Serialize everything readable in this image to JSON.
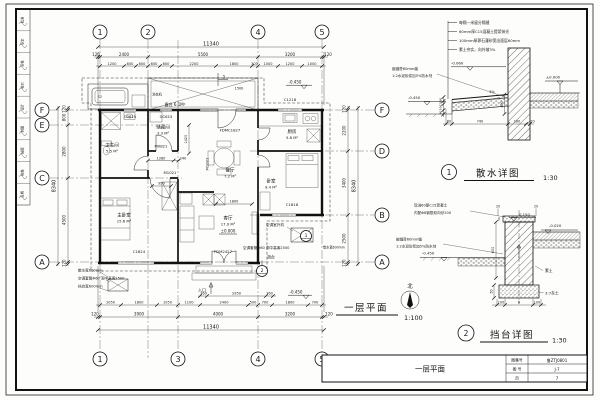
{
  "sheet": {
    "signature_cells": [
      "批准",
      "审定",
      "审核",
      "校对",
      "设计",
      "制图",
      "描图",
      "校核",
      "日期"
    ],
    "plan_title": "一层平面",
    "plan_scale": "1:100",
    "north_label": "北",
    "title_block": {
      "drawing_name": "一层平面",
      "atlas_label": "图集号",
      "atlas_no": "鲁ZTJ0801",
      "sheet_label": "图 号",
      "sheet_no": "J-7",
      "page_label": "页",
      "page_no": "7"
    }
  },
  "plan": {
    "grid": {
      "top": [
        "1",
        "2",
        "4",
        "5"
      ],
      "bottom": [
        "1",
        "3",
        "4",
        "5"
      ],
      "left": [
        "F",
        "E",
        "C",
        "A"
      ],
      "right": [
        "F",
        "D",
        "B",
        "A"
      ]
    },
    "dims": {
      "top_total": "11340",
      "top_major": [
        "120",
        "2400",
        "5500",
        "3200",
        "120"
      ],
      "top_minor": [
        "1200",
        "600",
        "600",
        "600",
        "600",
        "2200",
        "1800",
        "300",
        "1000",
        "1200",
        "1000"
      ],
      "bottom_total": "11340",
      "bottom_major": [
        "120",
        "3900",
        "4000",
        "3200",
        "120"
      ],
      "bottom_minor": [
        "1050",
        "1800",
        "1050",
        "1100",
        "2400",
        "500",
        "700",
        "1800",
        "700"
      ],
      "left_total": "8340",
      "left_segs": [
        "120",
        "800",
        "2800",
        "4500",
        "120"
      ],
      "right_total": "8340",
      "right_segs": [
        "120",
        "2200",
        "3400",
        "2500",
        "120"
      ],
      "entry": [
        "360",
        "2950",
        "360"
      ],
      "inner": [
        "1280",
        "240",
        "950",
        "1800",
        "1500",
        "1420"
      ]
    },
    "rooms": [
      {
        "name": "卫生间",
        "area": "5.5 M²"
      },
      {
        "name": "储藏间",
        "area": "3.3 M²"
      },
      {
        "name": "厨房",
        "area": "5.8 M²"
      },
      {
        "name": "餐厅",
        "area": "7.2 M²"
      },
      {
        "name": "主卧室",
        "area": "15.6 M²"
      },
      {
        "name": "客厅",
        "area": "17.0 M²"
      },
      {
        "name": "卧室",
        "area": "9.4 M²"
      }
    ],
    "terrace_label": "露台 6.1M²",
    "washer_label": "洗衣机",
    "openings": {
      "c0615": "C0615",
      "gc615": "GC615",
      "c1218": "C1218",
      "fdmc1827": "FDMC1827",
      "c1824": "C1824",
      "fdm2427": "FDM2427",
      "c1818": "C1818",
      "m0821": "M0821",
      "m1021a": "M1021",
      "m1021b": "M1021"
    },
    "levels": {
      "zero": "±0.000",
      "top": "-0.450",
      "bottom": "-0.450"
    },
    "notes": {
      "left1": "散水宽600mm",
      "left2": "空调套管Φ60 洞中高离2500",
      "left3": "挡台宽600mm",
      "right1": "空调室外机",
      "right2": "空调套管Φ60 洞中高离2500",
      "right3": "散水宽600mm",
      "dangtai": "挡台",
      "entry": "入口"
    },
    "markers": {
      "section": "1",
      "d1": "1",
      "d2": "2"
    }
  },
  "detail1": {
    "number": "1",
    "title": "散水详图",
    "scale": "1:30",
    "notes": [
      "每隔一米留分隔缝",
      "60mm厚C15混凝土提浆抹光",
      "100mm厚卵石灌砂宽出面层60mm",
      "素土夯实，向外坡3%"
    ],
    "side_notes": [
      "嵌缝膏60mm缝",
      "1:2水泥砂浆加5%防水剂"
    ],
    "levels": {
      "a": "-0.060",
      "b": "±0.000",
      "c": "-0.450"
    },
    "slope": "3%",
    "dim_v": "400",
    "dims_bottom": [
      "60",
      "740",
      "180",
      "20"
    ],
    "dims_left": [
      "60",
      "20",
      "100",
      "40"
    ]
  },
  "detail2": {
    "number": "2",
    "title": "挡台详图",
    "scale": "1:30",
    "notes": [
      "现浇60厚C15混凝土",
      "内配Φ6钢筋双向@200"
    ],
    "side_notes": [
      "嵌缝膏60mm缝",
      "1:2水泥砂浆加5%防水剂"
    ],
    "levels": {
      "a": "0.150",
      "b": "-0.020",
      "c": "-0.450"
    },
    "dims_top": [
      "20",
      "20"
    ],
    "dim_v": "600",
    "dim_cap": "50",
    "dim_base": "50",
    "dims_bottom": [
      "100",
      "B",
      "100"
    ],
    "lime_label": "3:7灰土",
    "soil_label": "素土"
  }
}
